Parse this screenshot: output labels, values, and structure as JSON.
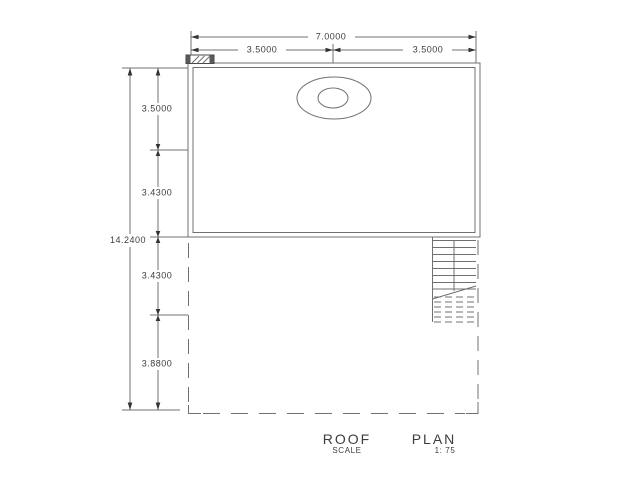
{
  "colors": {
    "background": "#ffffff",
    "line": "#707070",
    "text": "#3d3d3d",
    "arrow": "#333333"
  },
  "dimensions": {
    "top": {
      "total": "7.0000",
      "left_half": "3.5000",
      "right_half": "3.5000"
    },
    "left": {
      "total": "14.2400",
      "segment_1": "3.5000",
      "segment_2": "3.4300",
      "segment_3": "3.4300",
      "segment_4": "3.8800"
    }
  },
  "title": {
    "word_1": "ROOF",
    "word_2": "PLAN",
    "scale_label": "SCALE",
    "scale_value": "1: 75"
  }
}
